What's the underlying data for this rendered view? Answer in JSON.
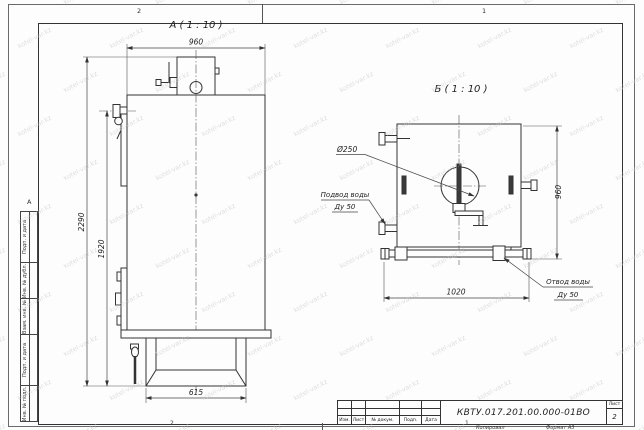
{
  "watermark": {
    "text": "kotel-var.kz",
    "color": "#c6c6c6"
  },
  "zones": {
    "top_left": "2",
    "top_right": "1",
    "bottom_left": "2",
    "bottom_right": "1",
    "left_letter": "А"
  },
  "margin_blocks": [
    "Подп. и дата",
    "Инв. № дубл.",
    "Взам. инв. №",
    "Подп. и дата",
    "Инв. № подл."
  ],
  "views": {
    "a": {
      "label": "А ( 1 : 10 )",
      "dim_width": "960",
      "dim_height_overall": "2290",
      "dim_height_body": "1920",
      "dim_base": "615"
    },
    "b": {
      "label": "Б ( 1 : 10 )",
      "dim_width": "1020",
      "dim_height": "960",
      "callout_flue": "Ø250",
      "inlet": [
        "Подвод воды",
        "Ду 50"
      ],
      "outlet": [
        "Отвод воды",
        "Ду 50"
      ]
    }
  },
  "title_block": {
    "doc_number": "КВТУ.017.201.00.000-01ВО",
    "revision_columns": [
      "Изм.",
      "Лист",
      "№ докум.",
      "Подп.",
      "Дата"
    ],
    "sheet_label": "Лист",
    "sheet_number": "2",
    "copy_label": "Копировал",
    "format_label": "Формат А3"
  }
}
